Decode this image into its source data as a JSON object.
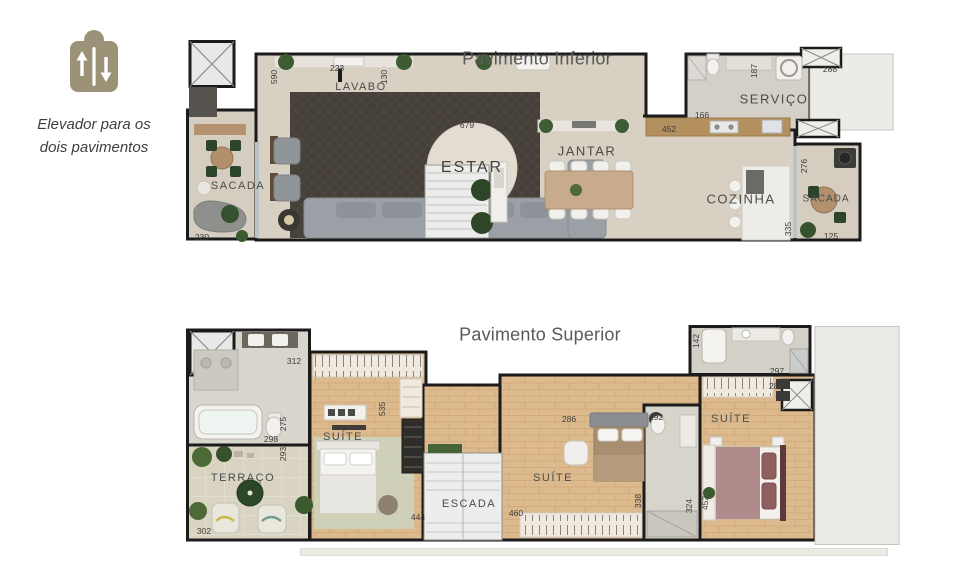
{
  "legend": {
    "icon": "elevator-up-down-icon",
    "line1": "Elevador para os",
    "line2": "dois pavimentos"
  },
  "plans": {
    "inferior": {
      "title": "Pavimento Inferior",
      "rooms": {
        "sacada_esq": "SACADA",
        "lavabo": "LAVABO",
        "estar": "ESTAR",
        "jantar": "JANTAR",
        "cozinha": "COZINHA",
        "servico": "SERVIÇO",
        "sacada_dir": "SACADA"
      },
      "dims": {
        "d230": "230",
        "d590": "590",
        "d223": "223",
        "d130": "130",
        "d144": "144",
        "d679": "679",
        "d604": "604",
        "d452": "452",
        "d187": "187",
        "d288": "288",
        "d166": "166",
        "d276": "276",
        "d335": "335",
        "d125": "125"
      }
    },
    "superior": {
      "title": "Pavimento Superior",
      "rooms": {
        "terraco": "TERRAÇO",
        "suite_master": "SUÍTE",
        "escada": "ESCADA",
        "suite_2": "SUÍTE",
        "suite_3": "SUÍTE"
      },
      "dims": {
        "d312": "312",
        "d275": "275",
        "d298": "298",
        "d293": "293",
        "d302": "302",
        "d535": "535",
        "d444": "444",
        "d460": "460",
        "d286": "286",
        "d192": "192",
        "d338": "338",
        "d324": "324",
        "d452": "452",
        "d142": "142",
        "d297": "297",
        "d282": "282"
      }
    }
  },
  "colors": {
    "accent_tan": "#9c9278",
    "wall": "#1b1b1b",
    "floor_beige": "#d8d1c3",
    "floor_wood": "#dcba8e",
    "rug_dark": "#45403a",
    "title_gray": "#595959"
  }
}
